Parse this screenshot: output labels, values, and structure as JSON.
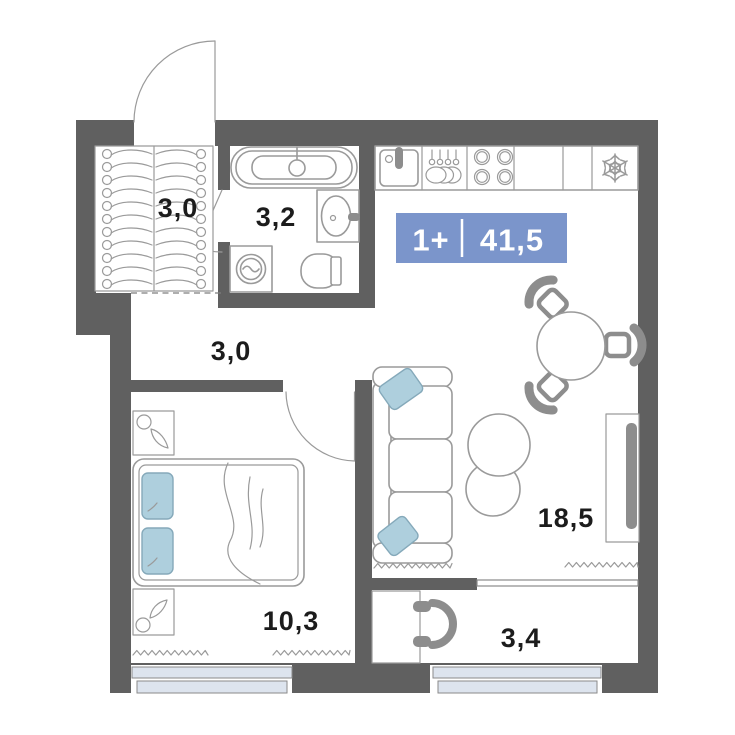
{
  "plan": {
    "badge": {
      "rooms": "1+",
      "area": "41,5"
    },
    "rooms": [
      {
        "name": "entry-closet",
        "area_label": "3,0"
      },
      {
        "name": "bathroom",
        "area_label": "3,2"
      },
      {
        "name": "hallway",
        "area_label": "3,0"
      },
      {
        "name": "bedroom",
        "area_label": "10,3"
      },
      {
        "name": "living-kitchen",
        "area_label": "18,5"
      },
      {
        "name": "balcony",
        "area_label": "3,4"
      }
    ],
    "icons": {
      "fridge": "snowflake-icon",
      "stove": "four-burners-icon",
      "kitchen_sink": "sink-icon",
      "dishes": "plates-and-utensils-icon",
      "wardrobe": "hanger-rail-icon",
      "radiator": "zigzag-icon"
    },
    "colors": {
      "wall": "#606060",
      "line": "#9a9a9a",
      "furn": "#8d8d8d",
      "pillow": "#aecfdd",
      "window": "#dde4ee",
      "badge": "#7b95cb",
      "text": "#1c1c1c"
    }
  }
}
